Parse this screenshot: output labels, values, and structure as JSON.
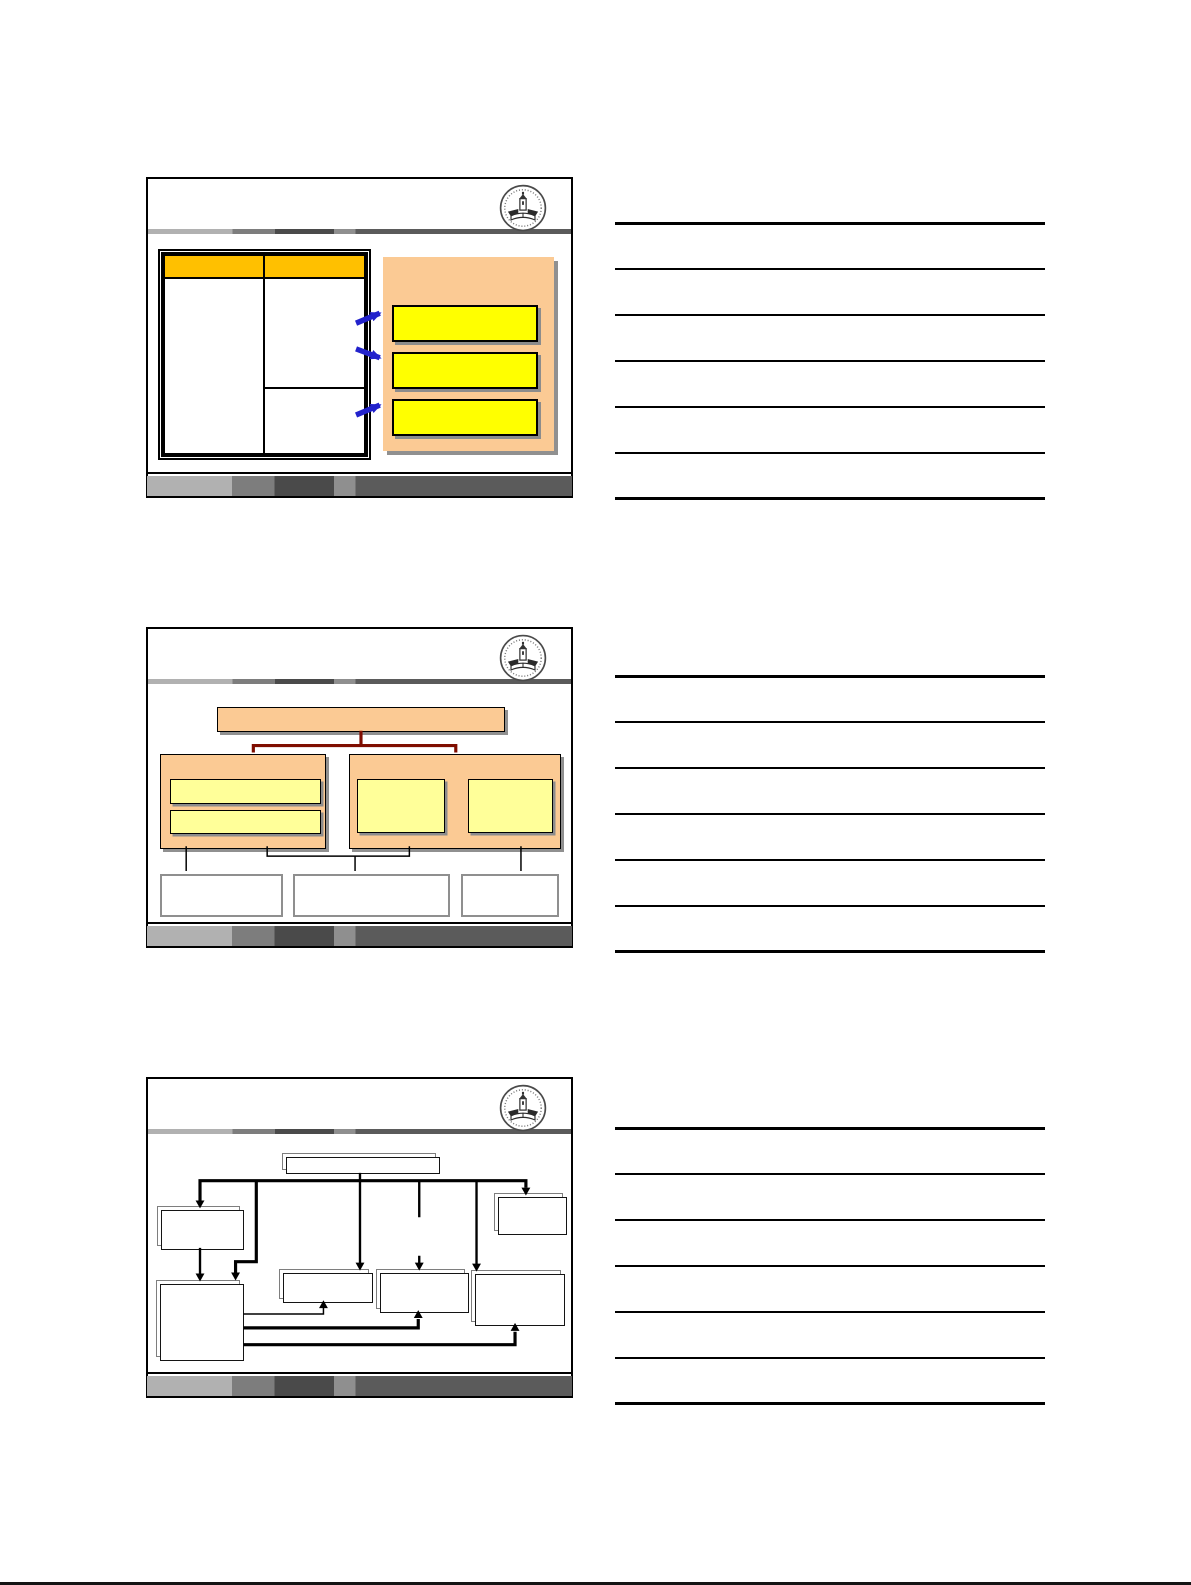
{
  "document": {
    "type": "presentation-handout-page",
    "slides_per_page": 3,
    "notes_lines_per_slide": 7,
    "visible_text": ""
  },
  "colors": {
    "gold": "#FFC000",
    "peach": "#FBCA94",
    "yellow": "#FFFF00",
    "lightyellow": "#FFFF99",
    "maroon": "#7F0D00",
    "blue": "#2222CC",
    "shadow": "#909090",
    "graybox": "#8F8F8F"
  },
  "slides": [
    {
      "id": 1,
      "name": "table-with-callouts",
      "elements": [
        "university-seal-logo",
        "gold-header-two-column-table",
        "peach-callout-panel",
        "three-yellow-callout-boxes",
        "three-blue-arrows"
      ]
    },
    {
      "id": 2,
      "name": "hierarchy-diagram",
      "elements": [
        "university-seal-logo",
        "peach-title-bar",
        "maroon-connector",
        "left-group-with-two-yellow-bars",
        "right-group-with-two-yellow-squares",
        "three-white-outcome-boxes"
      ]
    },
    {
      "id": 3,
      "name": "flowchart-diagram",
      "elements": [
        "university-seal-logo",
        "top-process-box",
        "distribution-line",
        "six-stacked-document-boxes",
        "feedback-arrows"
      ]
    }
  ]
}
